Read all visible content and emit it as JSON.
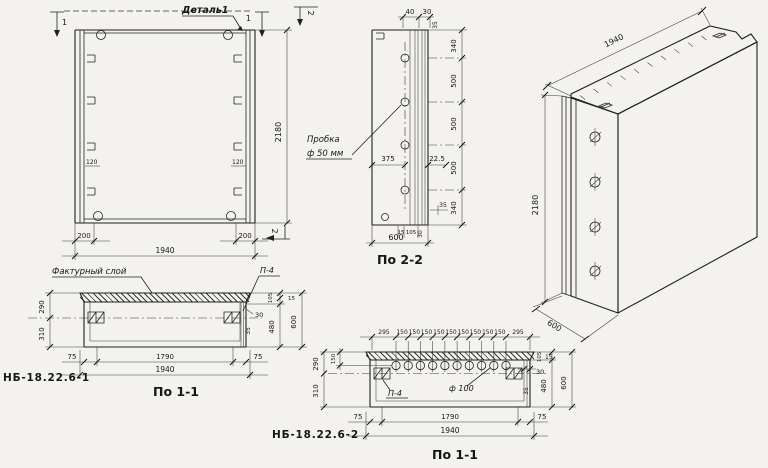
{
  "palette": {
    "paper": "#f3f2ee",
    "ink": "#1f1f1f"
  },
  "front": {
    "detail": "Деталь1",
    "mark1": "1",
    "mark2": "2",
    "rib_l": "120",
    "rib_r": "120",
    "height": "2180",
    "b_l": "200",
    "b_r": "200",
    "b_total": "1940"
  },
  "s22": {
    "title": "По 2-2",
    "t40": "40",
    "t30": "30",
    "t35": "35",
    "r0": "340",
    "r1": "500",
    "r2": "500",
    "r3": "500",
    "r4": "340",
    "plug1": "Пробка",
    "plug2": "ф 50 мм",
    "d375": "375",
    "d225": "22.5",
    "b15": "15",
    "b105": "105",
    "b30": "30",
    "b35": "35",
    "b600": "600"
  },
  "iso": {
    "length": "1940",
    "height": "2180",
    "depth": "600"
  },
  "s11a": {
    "title": "По 1-1",
    "facing": "Фактурный слой",
    "p4": "П-4",
    "l290": "290",
    "l310": "310",
    "r105": "105",
    "r15": "15",
    "r480": "480",
    "r600": "600",
    "rib30": "30",
    "rib35": "35",
    "b75l": "75",
    "b1790": "1790",
    "b75r": "75",
    "btotal": "1940",
    "mark": "НБ-18.22.6-1"
  },
  "s11b": {
    "title": "По 1-1",
    "p4": "П-4",
    "hole": "ф 100",
    "top": [
      "295",
      "150",
      "150",
      "150",
      "150",
      "150",
      "150",
      "150",
      "150",
      "150",
      "295"
    ],
    "l150": "150",
    "l290": "290",
    "l310": "310",
    "r105": "105",
    "r15": "15",
    "r30": "30",
    "r35": "35",
    "r480": "480",
    "r600": "600",
    "b75l": "75",
    "b1790": "1790",
    "b75r": "75",
    "btotal": "1940",
    "mark": "НБ-18.22.6-2"
  }
}
